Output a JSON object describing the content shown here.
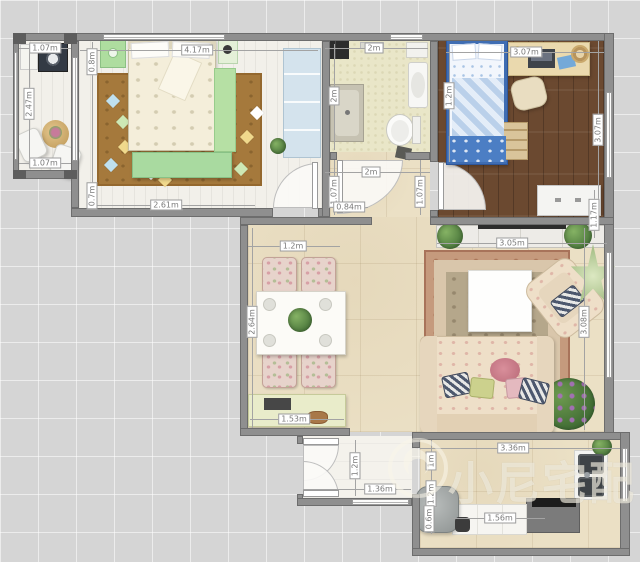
{
  "watermark": {
    "text": "小尼宅配"
  },
  "dims": {
    "balcony_top": "1.07m",
    "balcony_left": "2.47m",
    "balcony_bottom": "1.07m",
    "bedroom_top": "4.17m",
    "bedroom_left_upper": "0.8m",
    "bedroom_left_lower": "0.7m",
    "bedroom_bottom": "2.61m",
    "bathroom_top": "2m",
    "bathroom_left": "2m",
    "kids_top": "3.07m",
    "kids_bed": "1.2m",
    "kids_right": "3.07m",
    "kids_right_lower": "1.17m",
    "hall_width": "2m",
    "hall_left": "1.07m",
    "hall_door": "0.84m",
    "hall_right": "1.07m",
    "dining_top": "1.2m",
    "dining_left": "2.64m",
    "sideboard": "1.53m",
    "entry_height": "1.2m",
    "entry_bottom": "1.36m",
    "tv_console": "3.05m",
    "living_right": "3.08m",
    "kitchen_top": "3.36m",
    "kitchen_left_a": "1m",
    "kitchen_left_b": "1.2m",
    "kitchen_left_c": "0.6m",
    "kitchen_bottom": "1.56m"
  },
  "colors": {
    "wall": "#8f8f8f",
    "light_wood_floor": "#f2f0ea",
    "dark_wood_floor": "#6b4930",
    "beige_tile_floor": "#ebe0c5",
    "bath_tile_floor": "#e9e6c8",
    "bedroom_rug": "#a5793c",
    "kids_bed_blue": "#4f7ec4",
    "accent_green": "#a9daa0",
    "watermark": "rgba(249,245,233,0.6)"
  }
}
